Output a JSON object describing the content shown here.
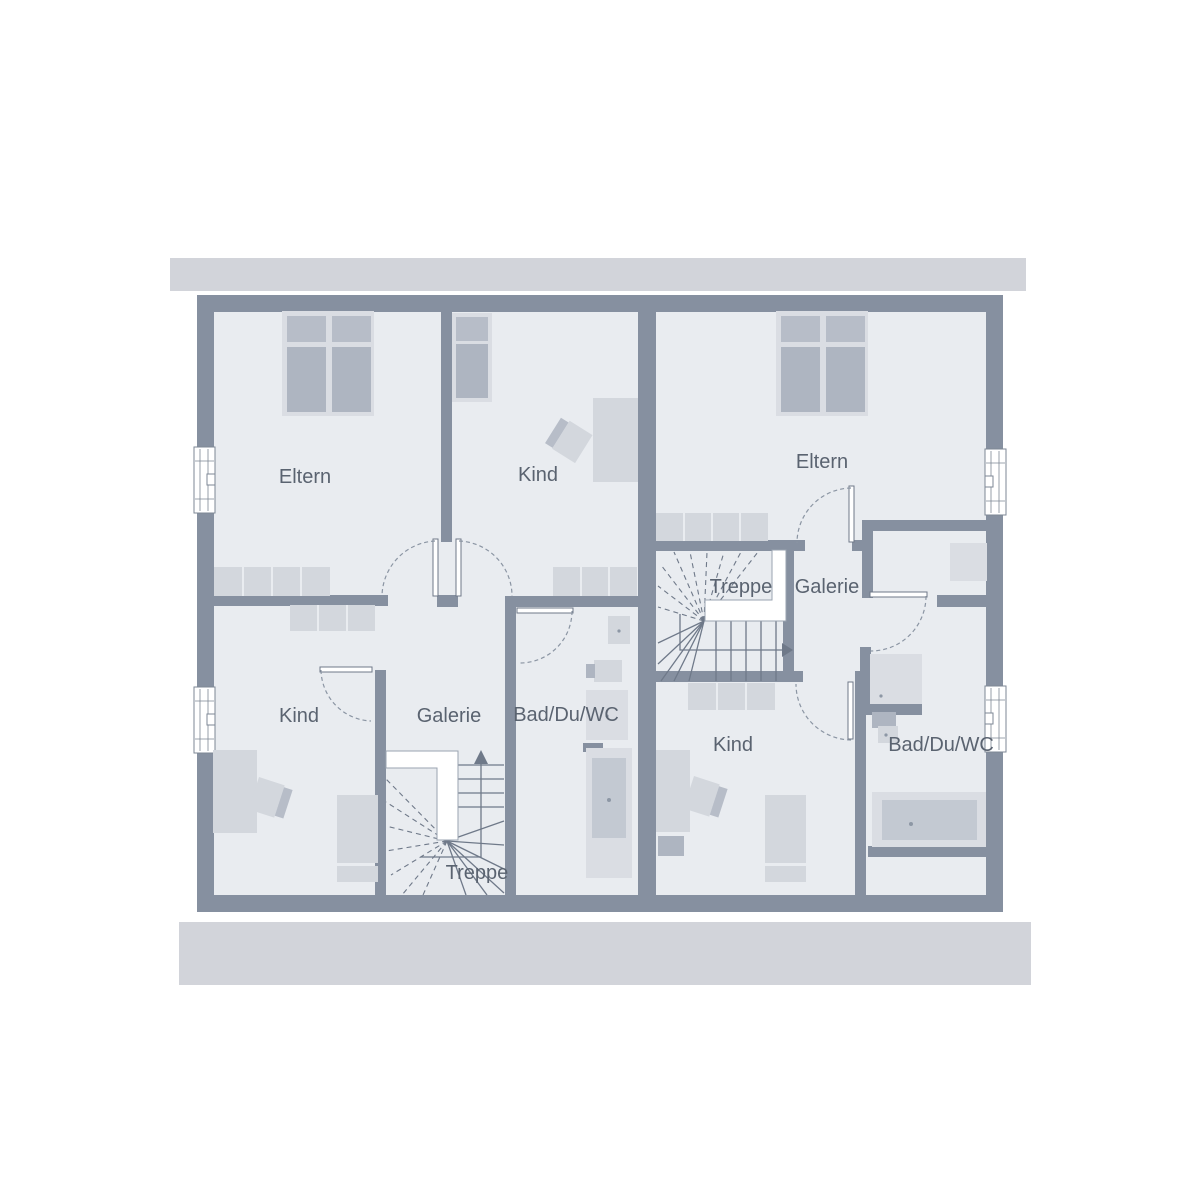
{
  "colors": {
    "wall": "#8690a0",
    "floor": "#e9ecf0",
    "roof_band": "#d2d4da",
    "line": "#6f7989",
    "text": "#5a6370",
    "furniture_light": "#dadde3",
    "furniture_soft": "#d3d7dd",
    "pillow": "#b7bdc8",
    "mattress": "#aeb5c1",
    "tub": "#c3c9d2"
  },
  "rooms": {
    "eltern_left": {
      "label": "Eltern"
    },
    "kind_top": {
      "label": "Kind"
    },
    "eltern_right": {
      "label": "Eltern"
    },
    "treppe_right": {
      "label": "Treppe"
    },
    "galerie_right": {
      "label": "Galerie"
    },
    "kind_left": {
      "label": "Kind"
    },
    "galerie_left": {
      "label": "Galerie"
    },
    "bad_left": {
      "label": "Bad/Du/WC"
    },
    "kind_right": {
      "label": "Kind"
    },
    "bad_right": {
      "label": "Bad/Du/WC"
    },
    "treppe_left": {
      "label": "Treppe"
    }
  }
}
